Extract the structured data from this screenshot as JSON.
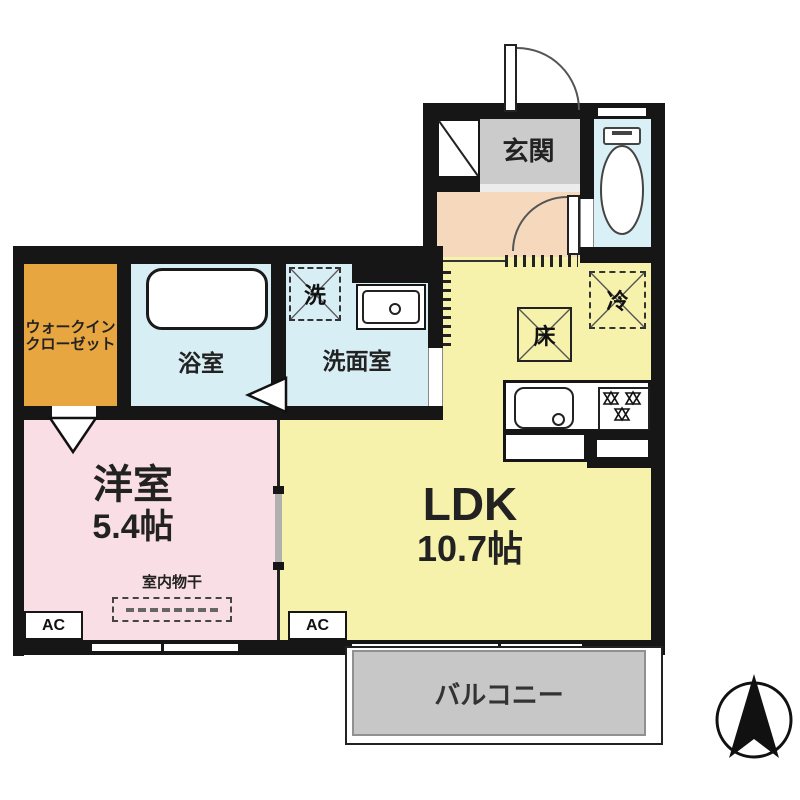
{
  "plan_type": "apartment-floor-plan",
  "rooms": {
    "genkan": {
      "label": "玄関"
    },
    "wic": {
      "label1": "ウォークイン",
      "label2": "クローゼット"
    },
    "bathroom": {
      "label": "浴室"
    },
    "washroom": {
      "label": "洗面室"
    },
    "ldk": {
      "label": "LDK",
      "size": "10.7帖"
    },
    "bedroom": {
      "label": "洋室",
      "size": "5.4帖"
    },
    "balcony": {
      "label": "バルコニー"
    }
  },
  "symbols": {
    "washer": "洗",
    "fridge": "冷",
    "floor_storage": "床",
    "ac_bedroom": "AC",
    "ac_ldk": "AC",
    "indoor_drying": "室内物干"
  },
  "colors": {
    "wall": "#161616",
    "ldk_floor": "#f6f2ab",
    "bedroom_floor": "#f9dfe5",
    "wet_area_floor": "#d8eef5",
    "toilet_floor": "#d9f0f6",
    "wic_floor": "#e8a640",
    "hallway_floor": "#f6d9bd",
    "genkan_floor": "#cbcbcb",
    "balcony_floor": "#c7c7c7"
  }
}
